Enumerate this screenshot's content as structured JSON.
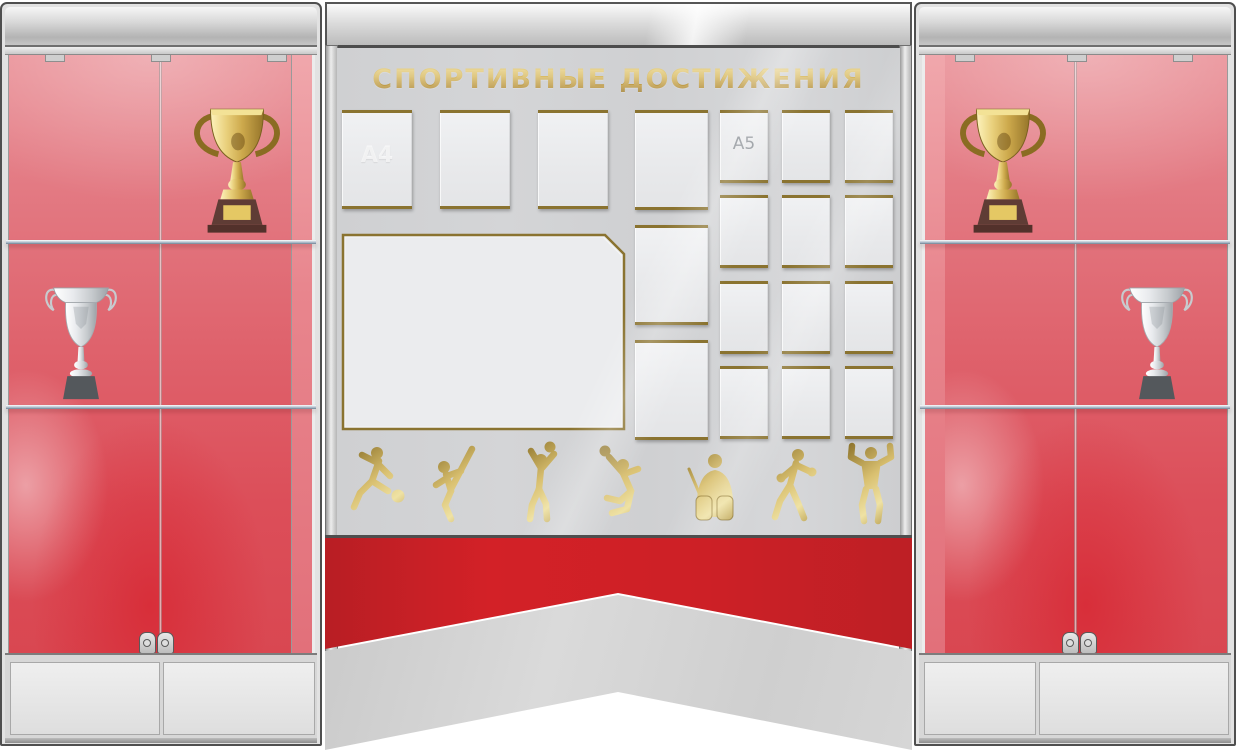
{
  "board": {
    "title": "СПОРТИВНЫЕ ДОСТИЖЕНИЯ",
    "pockets": {
      "a4_label": "A4",
      "a5_label": "A5",
      "a4_top_row_count": 3,
      "a4_side_column_count": 3,
      "a5_grid_rows": 4,
      "a5_grid_cols": 3,
      "large_pocket_count": 1
    },
    "sports_icons": [
      "soccer-player-icon",
      "karate-kick-icon",
      "volleyball-player-icon",
      "tennis-smash-icon",
      "hockey-goalie-icon",
      "boxer-icon",
      "bodybuilder-icon"
    ]
  },
  "cabinets": {
    "left": {
      "shelf_items": [
        "gold-trophy",
        "silver-cup"
      ],
      "shelf_count": 2,
      "door_count": 2,
      "lock_count": 2
    },
    "right": {
      "shelf_items": [
        "gold-trophy",
        "silver-cup"
      ],
      "shelf_count": 2,
      "door_count": 2,
      "lock_count": 2
    }
  },
  "colors": {
    "ribbon_red": "#cd2026",
    "cabinet_red": "#dc4e59",
    "gold": "#b7923c",
    "panel_gray": "#d2d3d5",
    "pocket_rail_gold": "#8a7330"
  }
}
